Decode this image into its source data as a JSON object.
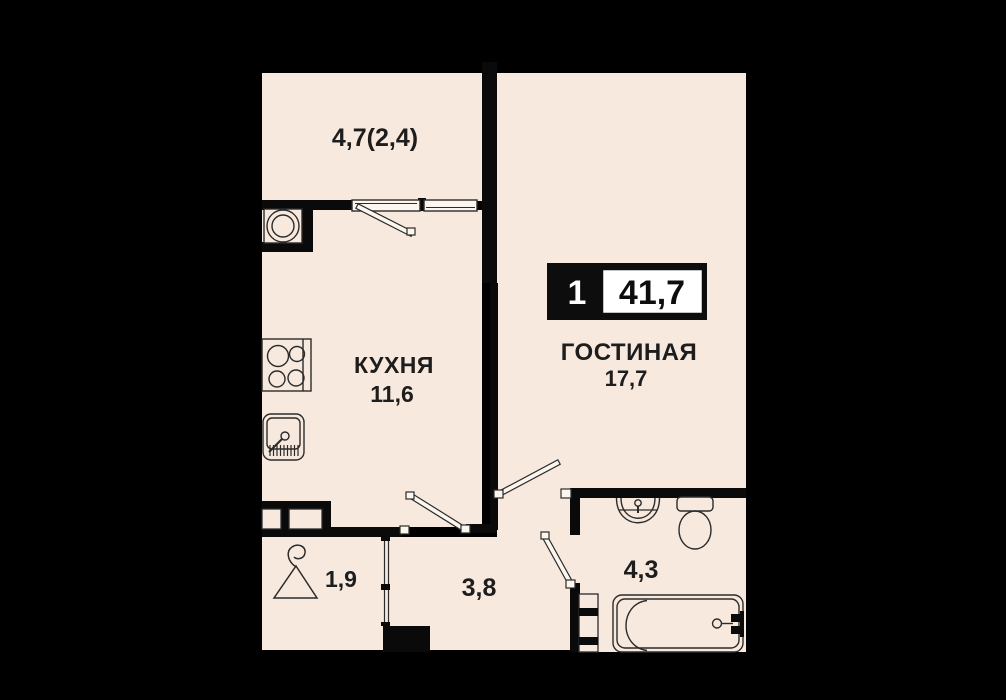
{
  "badge": {
    "room_count": "1",
    "total_area": "41,7"
  },
  "rooms": {
    "balcony": {
      "area": "4,7(2,4)"
    },
    "kitchen": {
      "name": "КУХНЯ",
      "area": "11,6"
    },
    "living": {
      "name": "ГОСТИНАЯ",
      "area": "17,7"
    },
    "hall": {
      "area": "3,8"
    },
    "wardrobe": {
      "area": "1,9"
    },
    "bathroom": {
      "area": "4,3"
    }
  },
  "colors": {
    "background": "#000000",
    "floor": "#f8e9de",
    "wall": "#0a0a0a",
    "line": "#2b2b2b",
    "badge_black": "#0d0d0d",
    "badge_white": "#ffffff"
  }
}
